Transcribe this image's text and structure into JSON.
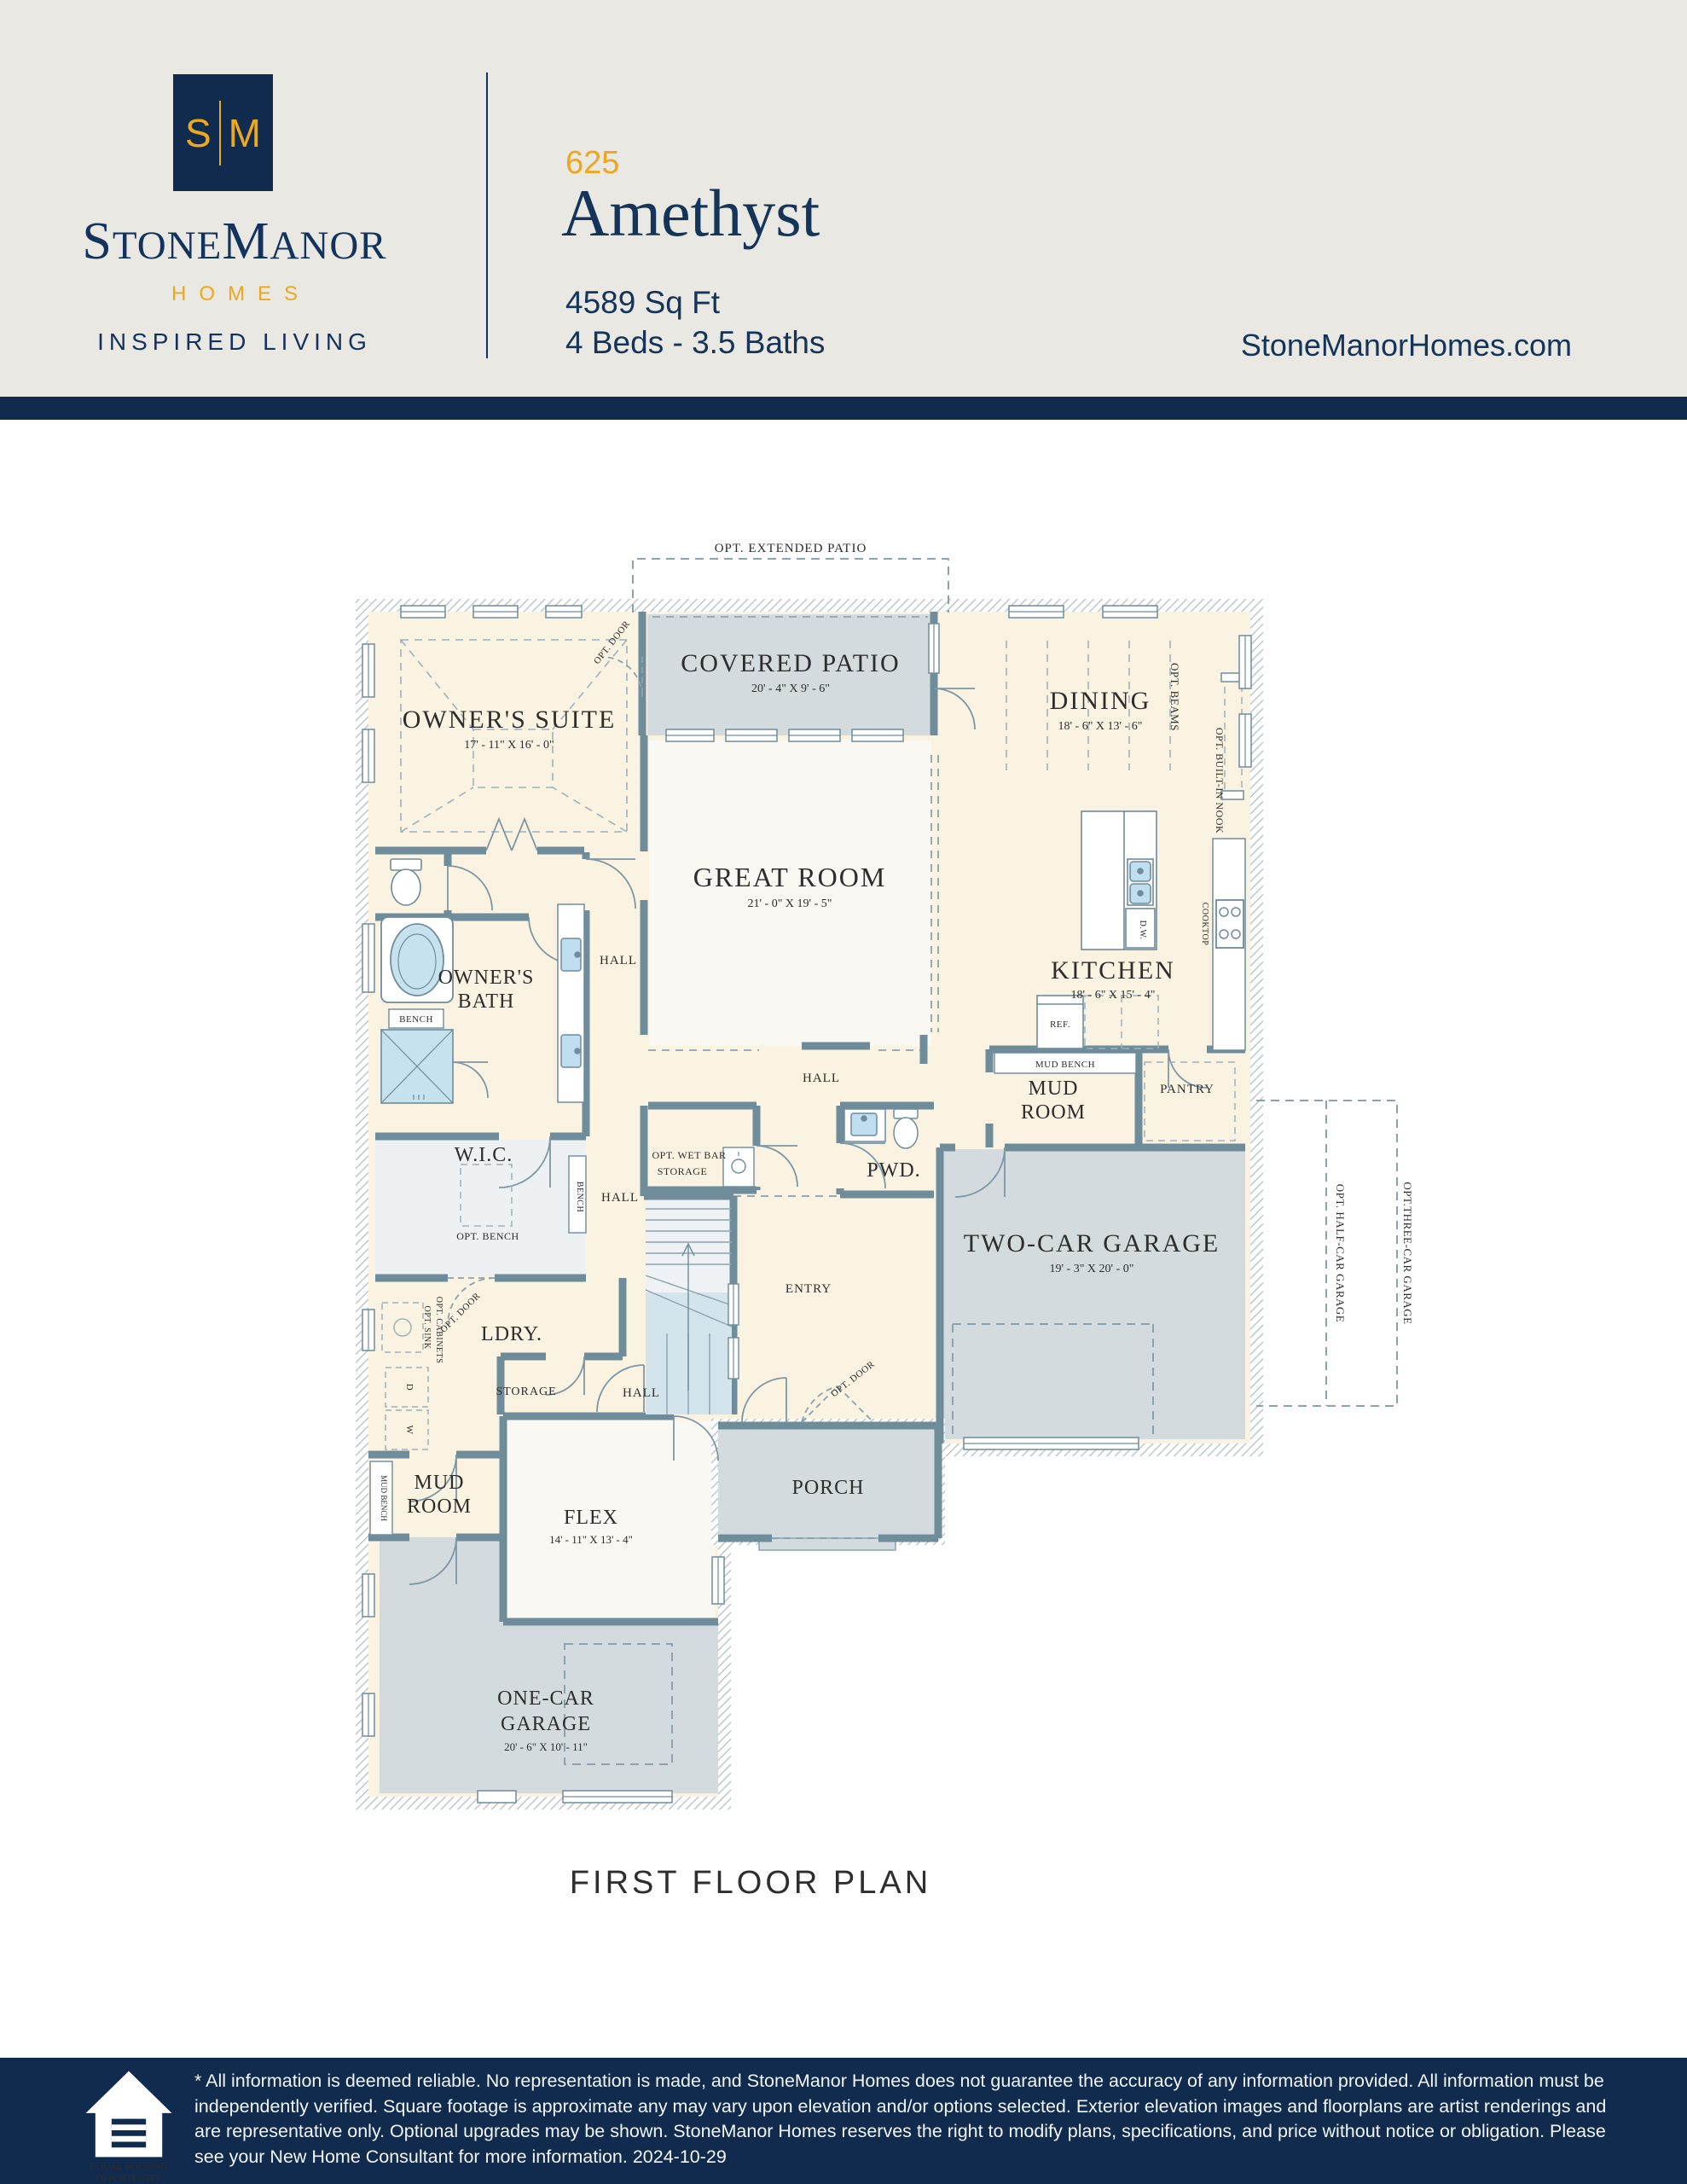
{
  "header": {
    "logo": {
      "s": "S",
      "m": "M",
      "brand": [
        "S",
        "tone",
        "M",
        "anor"
      ],
      "homes": "HOMES",
      "tagline": "INSPIRED LIVING"
    },
    "plan_number": "625",
    "plan_name": "Amethyst",
    "sqft": "4589 Sq Ft",
    "beds_baths": "4 Beds - 3.5 Baths",
    "website": "StoneManorHomes.com"
  },
  "plan": {
    "title": "FIRST FLOOR PLAN",
    "rooms": {
      "owners_suite": {
        "name": "OWNER'S SUITE",
        "dims": "17' - 11\" X 16' - 0\""
      },
      "covered_patio": {
        "name": "COVERED PATIO",
        "dims": "20' - 4\" X 9' - 6\""
      },
      "dining": {
        "name": "DINING",
        "dims": "18' - 6\" X 13' - 6\""
      },
      "great_room": {
        "name": "GREAT ROOM",
        "dims": "21' - 0\" X 19' - 5\""
      },
      "kitchen": {
        "name": "KITCHEN",
        "dims": "18' - 6\" X 15' - 4\""
      },
      "owners_bath": {
        "line1": "OWNER'S",
        "line2": "BATH"
      },
      "wic": {
        "name": "W.I.C."
      },
      "ldry": {
        "name": "LDRY."
      },
      "pwd": {
        "name": "PWD."
      },
      "entry": {
        "name": "ENTRY"
      },
      "flex": {
        "name": "FLEX",
        "dims": "14' - 11\" X 13' - 4\""
      },
      "porch": {
        "name": "PORCH"
      },
      "mud_room": {
        "line1": "MUD",
        "line2": "ROOM"
      },
      "pantry": {
        "name": "PANTRY"
      },
      "two_car_garage": {
        "name": "TWO-CAR GARAGE",
        "dims": "19' - 3\" X 20' - 0\""
      },
      "one_car_garage": {
        "line1": "ONE-CAR",
        "line2": "GARAGE",
        "dims": "20' - 6\" X 10' - 11\""
      }
    },
    "labels": {
      "hall": "HALL",
      "storage": "STORAGE",
      "opt_extended_patio": "OPT. EXTENDED PATIO",
      "opt_door": "OPT. DOOR",
      "opt_beams": "OPT. BEAMS",
      "opt_built_in_nook": "OPT. BUILT-IN NOOK",
      "opt_wet_bar": "OPT. WET BAR",
      "opt_bench": "OPT. BENCH",
      "bench": "BENCH",
      "mud_bench": "MUD BENCH",
      "opt_sink": "OPT. SINK",
      "opt_cabinets": "OPT. CABINETS",
      "cooktop": "COOKTOP",
      "ref": "REF.",
      "dw": "D.W.",
      "d": "D",
      "w": "W",
      "opt_half_car_garage": "OPT. HALF-CAR GARAGE",
      "opt_three_car_garage": "OPT.THREE-CAR GARAGE"
    }
  },
  "footer": {
    "disclaimer": "* All information is deemed reliable. No representation is made, and StoneManor Homes does not guarantee the accuracy of any information provided. All information must be independently verified. Square footage is approximate any may vary upon elevation and/or options selected. Exterior elevation images and floorplans are artist renderings and are representative only. Optional upgrades may be shown. StoneManor Homes reserves the right to modify plans, specifications, and price without notice or obligation. Please see your New Home Consultant for more information. 2024-10-29",
    "eho": [
      "EQUAL HOUSING",
      "OPPORTUNITY"
    ]
  },
  "colors": {
    "navy": "#102b4e",
    "gold": "#eca71f",
    "wall": "#6f8c9b",
    "cream": "#faf3e2",
    "floor_gray": "#d4dbde"
  }
}
